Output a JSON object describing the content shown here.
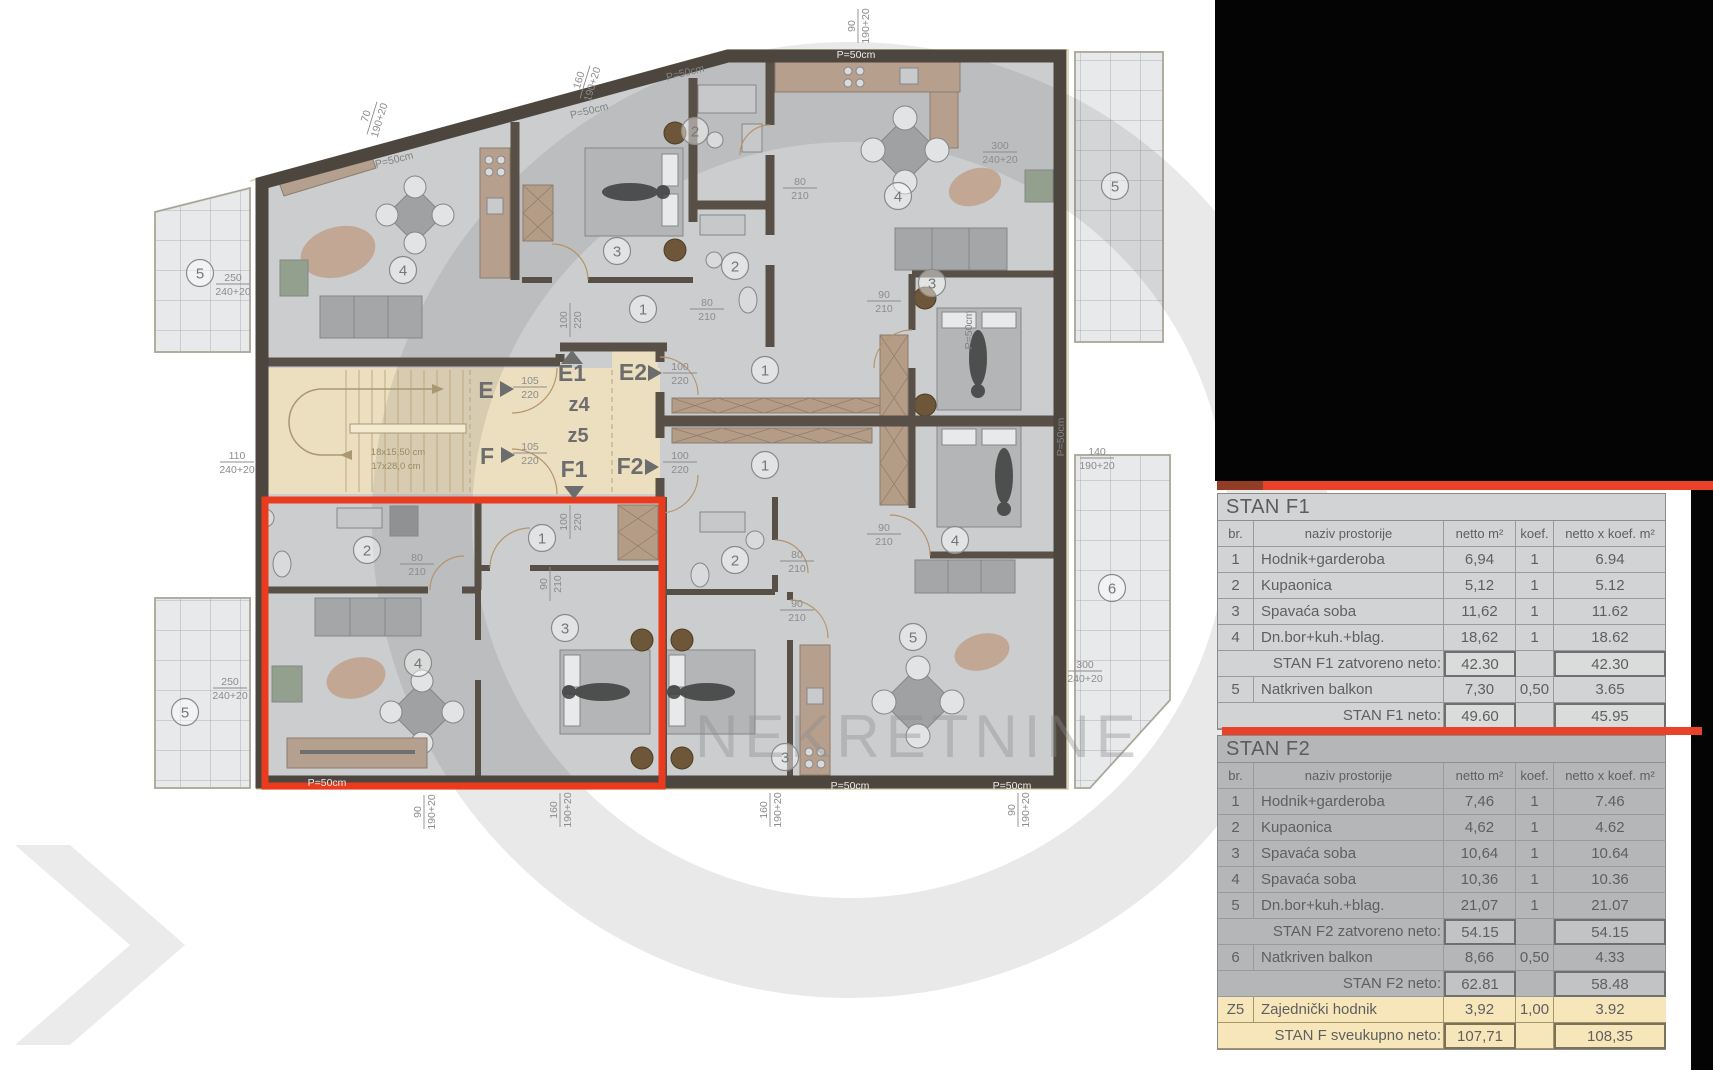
{
  "watermark": {
    "text": "NEKRETNINE"
  },
  "plan": {
    "wall_label": "P=50cm",
    "corridor": {
      "e": "E",
      "e1": "E1",
      "e2": "E2",
      "f": "F",
      "f1": "F1",
      "f2": "F2",
      "z4": "z4",
      "z5": "z5"
    },
    "stair_note": {
      "line1": "18x15,50 cm",
      "line2": "17x28,0 cm"
    },
    "rooms": [
      {
        "n": "4",
        "x": 403,
        "y": 270
      },
      {
        "n": "3",
        "x": 617,
        "y": 251
      },
      {
        "n": "2",
        "x": 695,
        "y": 131
      },
      {
        "n": "2",
        "x": 735,
        "y": 266
      },
      {
        "n": "1",
        "x": 643,
        "y": 309
      },
      {
        "n": "4",
        "x": 898,
        "y": 196
      },
      {
        "n": "3",
        "x": 932,
        "y": 283
      },
      {
        "n": "1",
        "x": 765,
        "y": 370
      },
      {
        "n": "5",
        "x": 1115,
        "y": 186
      },
      {
        "n": "1",
        "x": 542,
        "y": 538
      },
      {
        "n": "2",
        "x": 367,
        "y": 550
      },
      {
        "n": "3",
        "x": 565,
        "y": 628
      },
      {
        "n": "4",
        "x": 418,
        "y": 663
      },
      {
        "n": "5",
        "x": 200,
        "y": 273
      },
      {
        "n": "5",
        "x": 185,
        "y": 712
      },
      {
        "n": "1",
        "x": 765,
        "y": 465
      },
      {
        "n": "2",
        "x": 735,
        "y": 560
      },
      {
        "n": "3",
        "x": 785,
        "y": 757
      },
      {
        "n": "4",
        "x": 955,
        "y": 540
      },
      {
        "n": "5",
        "x": 913,
        "y": 637
      },
      {
        "n": "6",
        "x": 1112,
        "y": 588
      }
    ],
    "dims": [
      {
        "t": "250",
        "b": "240+20",
        "x": 233,
        "y": 284,
        "r": 0
      },
      {
        "t": "110",
        "b": "240+20",
        "x": 237,
        "y": 462,
        "r": 0
      },
      {
        "t": "250",
        "b": "240+20",
        "x": 230,
        "y": 688,
        "r": 0
      },
      {
        "t": "70",
        "b": "190+20",
        "x": 372,
        "y": 118,
        "r": -73
      },
      {
        "t": "160",
        "b": "190+20",
        "x": 585,
        "y": 82,
        "r": -73
      },
      {
        "t": "90",
        "b": "190+20",
        "x": 858,
        "y": 26,
        "r": -90
      },
      {
        "t": "300",
        "b": "240+20",
        "x": 1000,
        "y": 152,
        "r": 0
      },
      {
        "t": "140",
        "b": "190+20",
        "x": 1097,
        "y": 458,
        "r": 0
      },
      {
        "t": "300",
        "b": "240+20",
        "x": 1085,
        "y": 671,
        "r": 0
      },
      {
        "t": "90",
        "b": "190+20",
        "x": 424,
        "y": 812,
        "r": -90
      },
      {
        "t": "160",
        "b": "190+20",
        "x": 560,
        "y": 810,
        "r": -90
      },
      {
        "t": "160",
        "b": "190+20",
        "x": 770,
        "y": 810,
        "r": -90
      },
      {
        "t": "90",
        "b": "190+20",
        "x": 1018,
        "y": 810,
        "r": -90
      },
      {
        "t": "105",
        "b": "220",
        "x": 530,
        "y": 387,
        "r": 0
      },
      {
        "t": "105",
        "b": "220",
        "x": 530,
        "y": 453,
        "r": 0
      },
      {
        "t": "100",
        "b": "220",
        "x": 680,
        "y": 373,
        "r": 0
      },
      {
        "t": "100",
        "b": "220",
        "x": 680,
        "y": 462,
        "r": 0
      },
      {
        "t": "100",
        "b": "220",
        "x": 570,
        "y": 320,
        "r": -90
      },
      {
        "t": "100",
        "b": "220",
        "x": 570,
        "y": 522,
        "r": -90
      },
      {
        "t": "80",
        "b": "210",
        "x": 707,
        "y": 309,
        "r": 0
      },
      {
        "t": "80",
        "b": "210",
        "x": 800,
        "y": 188,
        "r": 0
      },
      {
        "t": "90",
        "b": "210",
        "x": 884,
        "y": 301,
        "r": 0
      },
      {
        "t": "90",
        "b": "210",
        "x": 884,
        "y": 534,
        "r": 0
      },
      {
        "t": "80",
        "b": "210",
        "x": 797,
        "y": 561,
        "r": 0
      },
      {
        "t": "90",
        "b": "210",
        "x": 797,
        "y": 610,
        "r": 0
      },
      {
        "t": "80",
        "b": "210",
        "x": 417,
        "y": 564,
        "r": 0
      },
      {
        "t": "90",
        "b": "210",
        "x": 550,
        "y": 584,
        "r": -90
      }
    ],
    "plabels": [
      {
        "x": 395,
        "y": 163,
        "r": -14,
        "light": false
      },
      {
        "x": 590,
        "y": 114,
        "r": -14,
        "light": false
      },
      {
        "x": 686,
        "y": 76,
        "r": -14,
        "light": false
      },
      {
        "x": 856,
        "y": 58,
        "r": 0,
        "light": true
      },
      {
        "x": 327,
        "y": 786,
        "r": 0,
        "light": true
      },
      {
        "x": 850,
        "y": 789,
        "r": 0,
        "light": true
      },
      {
        "x": 1012,
        "y": 789,
        "r": 0,
        "light": true
      },
      {
        "x": 972,
        "y": 330,
        "r": -90,
        "light": false
      },
      {
        "x": 1064,
        "y": 437,
        "r": -90,
        "light": false
      }
    ]
  },
  "tables": {
    "f1": {
      "title": "STAN F1",
      "headers": [
        "br.",
        "naziv prostorije",
        "netto m²",
        "koef.",
        "netto x koef. m²"
      ],
      "rows": [
        [
          "1",
          "Hodnik+garderoba",
          "6,94",
          "1",
          "6.94"
        ],
        [
          "2",
          "Kupaonica",
          "5,12",
          "1",
          "5.12"
        ],
        [
          "3",
          "Spavaća soba",
          "11,62",
          "1",
          "11.62"
        ],
        [
          "4",
          "Dn.bor+kuh.+blag.",
          "18,62",
          "1",
          "18.62"
        ]
      ],
      "closed": {
        "label": "STAN F1 zatvoreno neto:",
        "netto": "42.30",
        "total": "42.30"
      },
      "balcony": [
        "5",
        "Natkriven balkon",
        "7,30",
        "0,50",
        "3.65"
      ],
      "neto": {
        "label": "STAN F1 neto:",
        "netto": "49.60",
        "total": "45.95"
      }
    },
    "f2": {
      "title": "STAN F2",
      "headers": [
        "br.",
        "naziv prostorije",
        "netto m²",
        "koef.",
        "netto x koef. m²"
      ],
      "rows": [
        [
          "1",
          "Hodnik+garderoba",
          "7,46",
          "1",
          "7.46"
        ],
        [
          "2",
          "Kupaonica",
          "4,62",
          "1",
          "4.62"
        ],
        [
          "3",
          "Spavaća soba",
          "10,64",
          "1",
          "10.64"
        ],
        [
          "4",
          "Spavaća soba",
          "10,36",
          "1",
          "10.36"
        ],
        [
          "5",
          "Dn.bor+kuh.+blag.",
          "21,07",
          "1",
          "21.07"
        ]
      ],
      "closed": {
        "label": "STAN F2 zatvoreno neto:",
        "netto": "54.15",
        "total": "54.15"
      },
      "balcony": [
        "6",
        "Natkriven balkon",
        "8,66",
        "0,50",
        "4.33"
      ],
      "neto": {
        "label": "STAN F2 neto:",
        "netto": "62.81",
        "total": "58.48"
      }
    },
    "common": [
      "Z5",
      "Zajednički hodnik",
      "3,92",
      "1,00",
      "3.92"
    ],
    "grand": {
      "label": "STAN F sveukupno neto:",
      "netto": "107,71",
      "total": "108,35"
    }
  }
}
